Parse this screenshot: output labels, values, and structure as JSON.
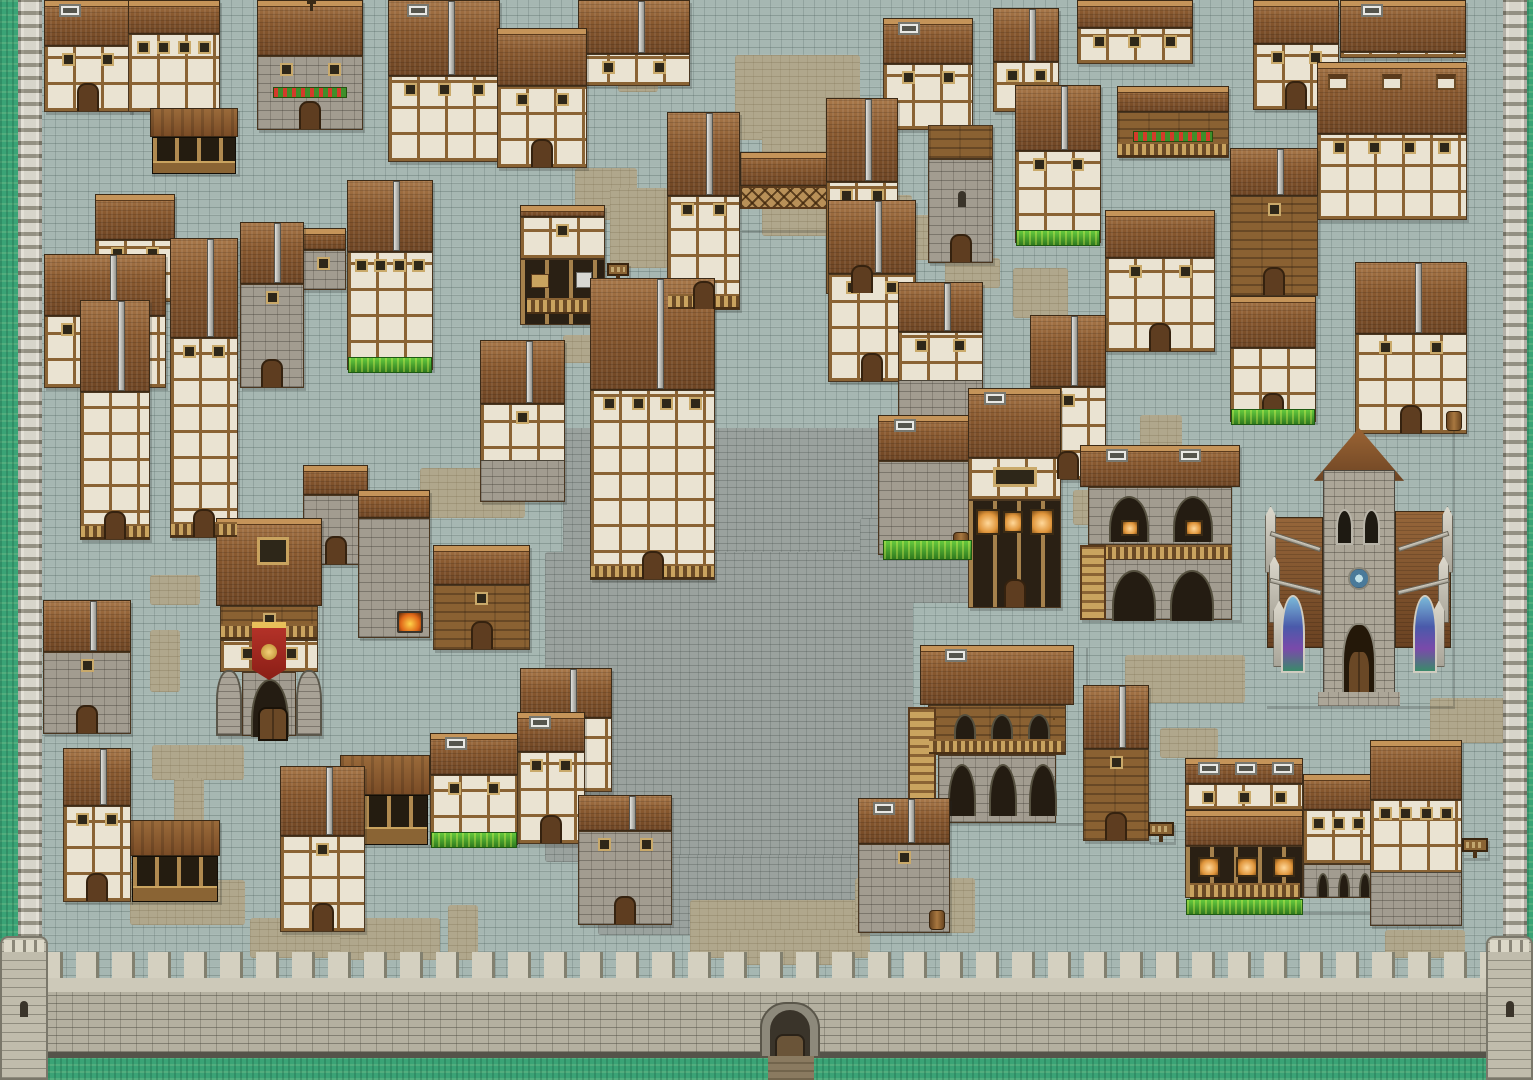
{
  "meta": {
    "description": "Pixel-art medieval walled town map, top-down 16-bit RPG style; no on-screen text or HUD",
    "viewport": {
      "width": 1533,
      "height": 1080
    }
  },
  "palette": {
    "cobblestone_street": "#a6b7b2",
    "plaza_stone": "#9aa29e",
    "dirt_path": "#b0a78c",
    "grass_outside": "#3aa376",
    "grass_strip": "#46a52e",
    "wall_stone_light": "#d4d0c0",
    "wall_stone": "#b4b0a0",
    "roof_brown": "#8a5a30",
    "roof_dark": "#6e4524",
    "timber_wall": "#eae3d2",
    "timber_beam": "#8a6334",
    "stone_wall": "#a29c90",
    "wood_wall": "#8a6132",
    "banner_red": "#b8342a",
    "banner_gold": "#e8c05a",
    "forge_fire": "#e06818",
    "stained_glass_blue": "#4a5aaa"
  },
  "map": {
    "rect_format": "x,y,w,h",
    "fortification": {
      "grass_borders": [
        {
          "name": "grass-west",
          "rect": [
            0,
            0,
            18,
            1080
          ]
        },
        {
          "name": "grass-east",
          "rect": [
            1527,
            0,
            6,
            1080
          ]
        },
        {
          "name": "grass-south",
          "rect": [
            0,
            1056,
            1533,
            24
          ]
        }
      ],
      "rampart_walks": [
        {
          "name": "west-wall-walk",
          "rect": [
            18,
            0,
            24,
            1012
          ]
        },
        {
          "name": "east-wall-walk",
          "rect": [
            1503,
            0,
            24,
            1012
          ]
        }
      ],
      "south_wall": {
        "rect": [
          40,
          952,
          1449,
          106
        ]
      },
      "corner_towers": [
        {
          "name": "southwest-corner-tower",
          "rect": [
            0,
            936,
            48,
            144
          ]
        },
        {
          "name": "southeast-corner-tower",
          "rect": [
            1486,
            936,
            47,
            144
          ]
        }
      ],
      "gate": {
        "name": "south-gate",
        "rect": [
          760,
          1002,
          60,
          56
        ],
        "path_rect": [
          768,
          1056,
          46,
          24
        ]
      }
    },
    "plaza_rects": [
      [
        700,
        428,
        208,
        130
      ],
      [
        563,
        428,
        140,
        230
      ],
      [
        545,
        552,
        368,
        310
      ],
      [
        598,
        855,
        262,
        80
      ],
      [
        860,
        518,
        110,
        85
      ]
    ],
    "dirt_patches": [
      [
        735,
        55,
        125,
        85
      ],
      [
        762,
        128,
        98,
        108
      ],
      [
        575,
        168,
        62,
        52
      ],
      [
        610,
        188,
        58,
        80
      ],
      [
        618,
        62,
        40,
        30
      ],
      [
        870,
        195,
        42,
        65
      ],
      [
        905,
        215,
        85,
        45
      ],
      [
        1013,
        268,
        55,
        50
      ],
      [
        945,
        258,
        55,
        30
      ],
      [
        1140,
        415,
        42,
        35
      ],
      [
        1073,
        490,
        42,
        35
      ],
      [
        563,
        335,
        72,
        28
      ],
      [
        480,
        418,
        85,
        45
      ],
      [
        420,
        468,
        105,
        50
      ],
      [
        150,
        575,
        50,
        30
      ],
      [
        150,
        630,
        30,
        62
      ],
      [
        152,
        745,
        92,
        35
      ],
      [
        174,
        778,
        30,
        122
      ],
      [
        130,
        880,
        115,
        45
      ],
      [
        250,
        918,
        120,
        40
      ],
      [
        340,
        918,
        100,
        42
      ],
      [
        448,
        905,
        30,
        55
      ],
      [
        690,
        900,
        180,
        58
      ],
      [
        855,
        878,
        120,
        55
      ],
      [
        730,
        930,
        120,
        35
      ],
      [
        1125,
        655,
        120,
        48
      ],
      [
        1160,
        728,
        58,
        30
      ],
      [
        1430,
        698,
        100,
        45
      ],
      [
        1385,
        930,
        80,
        28
      ]
    ],
    "grass_strips": [
      [
        883,
        540,
        87,
        18
      ]
    ],
    "buildings": [
      {
        "name": "house-1",
        "type": "timber",
        "x": 44,
        "y": 0,
        "w": 88,
        "h": 112,
        "roof_h": 46,
        "gable": "front",
        "windows": 2,
        "door": true,
        "chimney": true
      },
      {
        "name": "house-2",
        "type": "timber",
        "x": 128,
        "y": 0,
        "w": 92,
        "h": 112,
        "roof_h": 34,
        "gable": "front",
        "windows": 4
      },
      {
        "name": "flower-house-1",
        "type": "stone",
        "x": 257,
        "y": 0,
        "w": 106,
        "h": 130,
        "roof_h": 56,
        "gable": "front",
        "windows": 2,
        "door": true,
        "flowers": true,
        "finial": true
      },
      {
        "name": "market-stall-1",
        "type": "stall",
        "x": 150,
        "y": 108,
        "w": 88,
        "h": 66
      },
      {
        "name": "house-3",
        "type": "timber",
        "x": 388,
        "y": 0,
        "w": 112,
        "h": 162,
        "roof_h": 76,
        "gable": "side",
        "windows": 3,
        "chimney": true
      },
      {
        "name": "house-4",
        "type": "timber",
        "x": 497,
        "y": 28,
        "w": 90,
        "h": 140,
        "roof_h": 58,
        "gable": "front",
        "windows": 2,
        "door": true
      },
      {
        "name": "house-5",
        "type": "timber",
        "x": 578,
        "y": 0,
        "w": 112,
        "h": 86,
        "roof_h": 54,
        "gable": "side",
        "windows": 2
      },
      {
        "name": "bridge-house-west",
        "type": "timber",
        "x": 667,
        "y": 112,
        "w": 73,
        "h": 198,
        "roof_h": 84,
        "gable": "side",
        "windows": 2,
        "door": true,
        "balcony": true
      },
      {
        "name": "bridge-span",
        "type": "bridge",
        "x": 740,
        "y": 152,
        "w": 88,
        "h": 78
      },
      {
        "name": "bridge-house-east",
        "type": "timber",
        "x": 826,
        "y": 98,
        "w": 72,
        "h": 196,
        "roof_h": 84,
        "gable": "side",
        "windows": 2,
        "door": true
      },
      {
        "name": "house-6",
        "type": "timber",
        "x": 883,
        "y": 18,
        "w": 90,
        "h": 112,
        "roof_h": 46,
        "gable": "front",
        "windows": 2,
        "chimney": true
      },
      {
        "name": "stone-tower-north",
        "type": "tower",
        "x": 928,
        "y": 125,
        "w": 65,
        "h": 138,
        "roof_h": 34,
        "door": true
      },
      {
        "name": "house-8",
        "type": "timber",
        "x": 993,
        "y": 8,
        "w": 66,
        "h": 104,
        "roof_h": 54,
        "gable": "side",
        "windows": 2
      },
      {
        "name": "house-7",
        "type": "timber",
        "x": 1015,
        "y": 85,
        "w": 86,
        "h": 158,
        "roof_h": 66,
        "gable": "side",
        "windows": 2,
        "grass": true
      },
      {
        "name": "house-9",
        "type": "timber",
        "x": 1077,
        "y": 0,
        "w": 116,
        "h": 64,
        "roof_h": 28,
        "gable": "front",
        "windows": 3
      },
      {
        "name": "balcony-house",
        "type": "wood",
        "x": 1117,
        "y": 86,
        "w": 112,
        "h": 72,
        "roof_h": 26,
        "gable": "front",
        "flowers": true,
        "balcony": true
      },
      {
        "name": "house-11",
        "type": "timber",
        "x": 1105,
        "y": 210,
        "w": 110,
        "h": 142,
        "roof_h": 48,
        "gable": "front",
        "windows": 2,
        "door": true
      },
      {
        "name": "house-10",
        "type": "timber",
        "x": 1253,
        "y": 0,
        "w": 86,
        "h": 110,
        "roof_h": 44,
        "gable": "front",
        "windows": 2,
        "door": true
      },
      {
        "name": "roof-house",
        "type": "timber",
        "x": 1340,
        "y": 0,
        "w": 126,
        "h": 58,
        "roof_h": 52,
        "gable": "front",
        "chimney": true
      },
      {
        "name": "dormer-house",
        "type": "timber",
        "x": 1317,
        "y": 62,
        "w": 150,
        "h": 158,
        "roof_h": 72,
        "gable": "front",
        "windows": 4,
        "dormers": 3
      },
      {
        "name": "wood-tower",
        "type": "wood",
        "x": 1230,
        "y": 148,
        "w": 88,
        "h": 148,
        "roof_h": 48,
        "gable": "side",
        "windows": 1,
        "door": true
      },
      {
        "name": "house-12",
        "type": "timber",
        "x": 1230,
        "y": 296,
        "w": 86,
        "h": 126,
        "roof_h": 52,
        "gable": "front",
        "door": true,
        "grass": true
      },
      {
        "name": "house-13",
        "type": "timber",
        "x": 1355,
        "y": 262,
        "w": 112,
        "h": 172,
        "roof_h": 72,
        "gable": "side",
        "windows": 2,
        "door": true,
        "barrel": true
      },
      {
        "name": "house-14",
        "type": "timber",
        "x": 95,
        "y": 194,
        "w": 80,
        "h": 108,
        "roof_h": 46,
        "gable": "front",
        "windows": 2
      },
      {
        "name": "house-15",
        "type": "timber",
        "x": 44,
        "y": 254,
        "w": 122,
        "h": 134,
        "roof_h": 62,
        "gable": "side",
        "windows": 3
      },
      {
        "name": "tall-house-west",
        "type": "timber",
        "x": 80,
        "y": 300,
        "w": 70,
        "h": 240,
        "roof_h": 92,
        "gable": "side",
        "door": true,
        "balcony": true
      },
      {
        "name": "tall-house-2",
        "type": "timber",
        "x": 170,
        "y": 238,
        "w": 68,
        "h": 300,
        "roof_h": 100,
        "gable": "side",
        "windows": 2,
        "balcony": true,
        "door": true
      },
      {
        "name": "house-16",
        "type": "stone",
        "x": 240,
        "y": 222,
        "w": 64,
        "h": 166,
        "roof_h": 62,
        "gable": "side",
        "door": true,
        "windows": 1
      },
      {
        "name": "house-17",
        "type": "stone",
        "x": 300,
        "y": 228,
        "w": 46,
        "h": 62,
        "roof_h": 22,
        "gable": "front",
        "windows": 1
      },
      {
        "name": "big-house-west",
        "type": "timber",
        "x": 347,
        "y": 180,
        "w": 86,
        "h": 190,
        "roof_h": 72,
        "gable": "side",
        "windows": 4,
        "grass": true
      },
      {
        "name": "shop-armory",
        "type": "shop",
        "x": 520,
        "y": 205,
        "w": 85,
        "h": 120
      },
      {
        "name": "smith-sign",
        "type": "sign",
        "x": 607,
        "y": 263,
        "w": 22,
        "h": 18
      },
      {
        "name": "tall-house-center",
        "type": "timber",
        "x": 590,
        "y": 278,
        "w": 125,
        "h": 302,
        "roof_h": 112,
        "gable": "side",
        "windows": 4,
        "door": true,
        "balcony": true
      },
      {
        "name": "house-19",
        "type": "timber",
        "x": 828,
        "y": 200,
        "w": 88,
        "h": 182,
        "roof_h": 74,
        "gable": "side",
        "windows": 2,
        "door": true
      },
      {
        "name": "house-20",
        "type": "timber",
        "x": 898,
        "y": 282,
        "w": 85,
        "h": 135,
        "roof_h": 50,
        "gable": "side",
        "windows": 2,
        "stonebase": true
      },
      {
        "name": "house-21",
        "type": "timber",
        "x": 1030,
        "y": 315,
        "w": 76,
        "h": 165,
        "roof_h": 72,
        "gable": "side",
        "windows": 1,
        "door": true
      },
      {
        "name": "warehouse",
        "type": "stone",
        "x": 878,
        "y": 415,
        "w": 96,
        "h": 140,
        "roof_h": 46,
        "gable": "front",
        "barrel": true,
        "chimney": true
      },
      {
        "name": "general-store",
        "type": "shop2",
        "x": 968,
        "y": 388,
        "w": 93,
        "h": 220
      },
      {
        "name": "bakery-arches",
        "type": "archbridge",
        "x": 1080,
        "y": 445,
        "w": 160,
        "h": 175
      },
      {
        "name": "house-smith",
        "type": "timber",
        "x": 480,
        "y": 340,
        "w": 85,
        "h": 162,
        "roof_h": 64,
        "gable": "side",
        "stonebase": true,
        "windows": 1
      },
      {
        "name": "arch-house",
        "type": "stone",
        "x": 303,
        "y": 465,
        "w": 65,
        "h": 100,
        "roof_h": 30,
        "gable": "front",
        "door": true
      },
      {
        "name": "smithy-forge",
        "type": "stone",
        "x": 358,
        "y": 490,
        "w": 72,
        "h": 148,
        "roof_h": 28,
        "gable": "front",
        "forge": true
      },
      {
        "name": "porch-house",
        "type": "wood",
        "x": 433,
        "y": 545,
        "w": 97,
        "h": 105,
        "roof_h": 40,
        "gable": "front",
        "door": true,
        "windows": 1
      },
      {
        "name": "guild-inn",
        "type": "inn",
        "x": 216,
        "y": 518,
        "w": 106,
        "h": 218
      },
      {
        "name": "house-22",
        "type": "stone",
        "x": 43,
        "y": 600,
        "w": 88,
        "h": 134,
        "roof_h": 52,
        "gable": "side",
        "windows": 1,
        "door": true
      },
      {
        "name": "house-23",
        "type": "timber",
        "x": 63,
        "y": 748,
        "w": 68,
        "h": 154,
        "roof_h": 58,
        "gable": "side",
        "windows": 2,
        "door": true
      },
      {
        "name": "stable",
        "type": "stall",
        "x": 130,
        "y": 820,
        "w": 90,
        "h": 82
      },
      {
        "name": "house-24",
        "type": "timber",
        "x": 280,
        "y": 766,
        "w": 85,
        "h": 166,
        "roof_h": 70,
        "gable": "side",
        "windows": 1,
        "door": true
      },
      {
        "name": "stall-row",
        "type": "stall",
        "x": 340,
        "y": 755,
        "w": 90,
        "h": 90
      },
      {
        "name": "house-25",
        "type": "timber",
        "x": 430,
        "y": 733,
        "w": 88,
        "h": 112,
        "roof_h": 42,
        "gable": "front",
        "windows": 2,
        "grass": true,
        "chimney": true
      },
      {
        "name": "house-27",
        "type": "timber",
        "x": 520,
        "y": 668,
        "w": 92,
        "h": 124,
        "roof_h": 50,
        "gable": "side",
        "windows": 1
      },
      {
        "name": "house-26",
        "type": "timber",
        "x": 517,
        "y": 712,
        "w": 68,
        "h": 132,
        "roof_h": 40,
        "gable": "front",
        "windows": 2,
        "door": true,
        "chimney": true
      },
      {
        "name": "stone-house-south",
        "type": "stone",
        "x": 578,
        "y": 795,
        "w": 94,
        "h": 130,
        "roof_h": 36,
        "gable": "side",
        "windows": 2,
        "door": true
      },
      {
        "name": "barrel-house",
        "type": "stone",
        "x": 858,
        "y": 798,
        "w": 92,
        "h": 135,
        "roof_h": 46,
        "gable": "side",
        "windows": 1,
        "barrel": true,
        "chimney": true
      },
      {
        "name": "stilt-lodge",
        "type": "lodge",
        "x": 908,
        "y": 645,
        "w": 178,
        "h": 178
      },
      {
        "name": "house-30",
        "type": "wood",
        "x": 1083,
        "y": 685,
        "w": 66,
        "h": 156,
        "roof_h": 64,
        "gable": "side",
        "door": true,
        "windows": 1
      },
      {
        "name": "sign-west",
        "type": "sign",
        "x": 1148,
        "y": 822,
        "w": 26,
        "h": 20
      },
      {
        "name": "tavern",
        "type": "tavern",
        "x": 1185,
        "y": 758,
        "w": 188,
        "h": 154
      },
      {
        "name": "house-31",
        "type": "timber",
        "x": 1370,
        "y": 740,
        "w": 92,
        "h": 186,
        "roof_h": 60,
        "gable": "front",
        "windows": 4,
        "stonebase": true
      },
      {
        "name": "sign-east",
        "type": "sign",
        "x": 1462,
        "y": 838,
        "w": 26,
        "h": 20
      },
      {
        "name": "church",
        "type": "church",
        "x": 1265,
        "y": 428,
        "w": 188,
        "h": 278
      }
    ]
  }
}
